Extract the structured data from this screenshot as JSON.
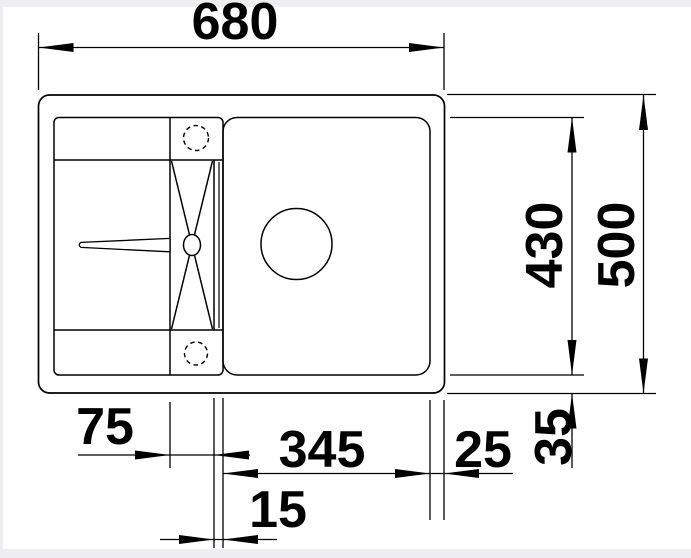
{
  "dims": {
    "overall_width": "680",
    "overall_depth": "500",
    "bowl_length": "430",
    "bowl_width": "345",
    "channel_width": "75",
    "right_offset": "25",
    "bottom_offset": "35",
    "divider_width": "15"
  },
  "colors": {
    "line": "#000000",
    "background": "#ffffff",
    "frame_edge": "#eeeef0"
  }
}
